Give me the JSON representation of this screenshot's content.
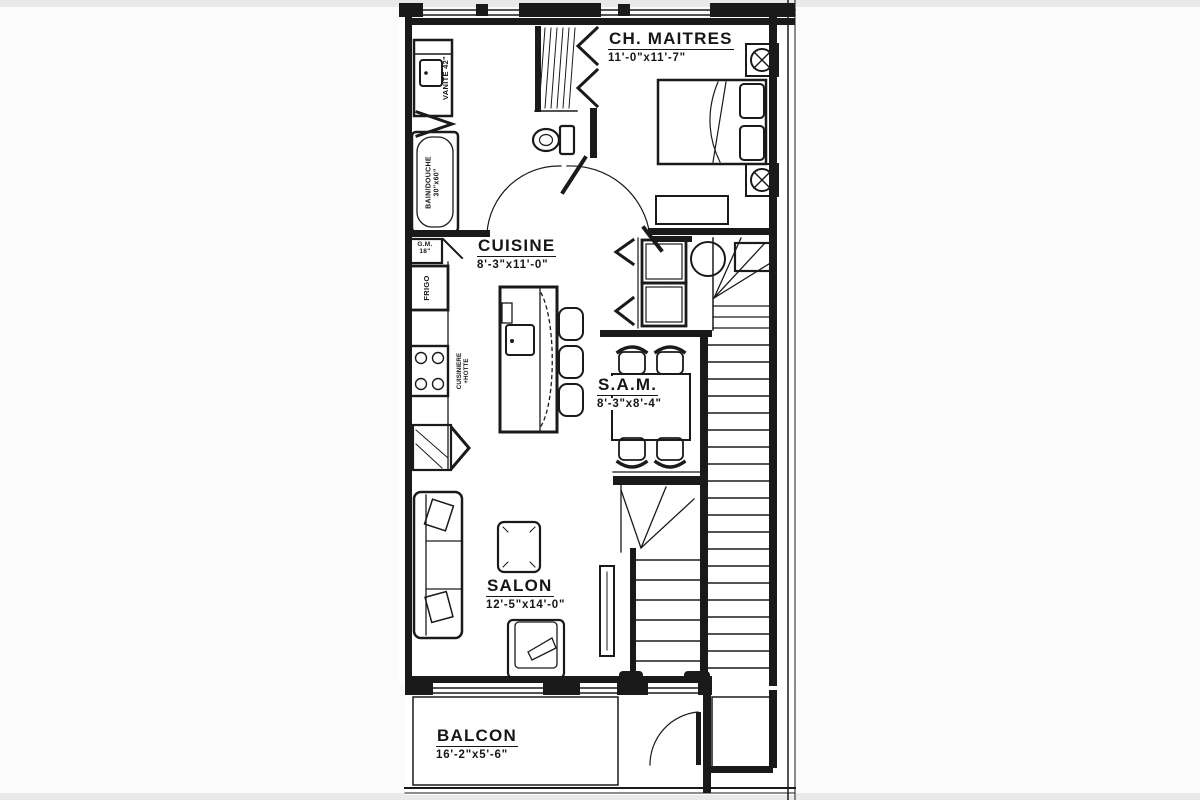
{
  "page": {
    "background": "#fbfbfb",
    "ink": "#1a1a1a"
  },
  "rooms": {
    "master": {
      "name": "CH. MAITRES",
      "dims": "11'-0\"x11'-7\""
    },
    "kitchen": {
      "name": "CUISINE",
      "dims": "8'-3\"x11'-0\""
    },
    "dining": {
      "name": "S.A.M.",
      "dims": "8'-3\"x8'-4\""
    },
    "living": {
      "name": "SALON",
      "dims": "12'-5\"x14'-0\""
    },
    "balcony": {
      "name": "BALCON",
      "dims": "16'-2\"x5'-6\""
    }
  },
  "fixtures": {
    "vanity": "VANITE 42\"",
    "bath_line1": "BAIN/DOUCHE",
    "bath_line2": "30\"x60\"",
    "pantry_line1": "G.M.",
    "pantry_line2": "18\"",
    "fridge": "FRIGO",
    "stove_line1": "CUISINIERE",
    "stove_line2": "+HOTTE"
  }
}
